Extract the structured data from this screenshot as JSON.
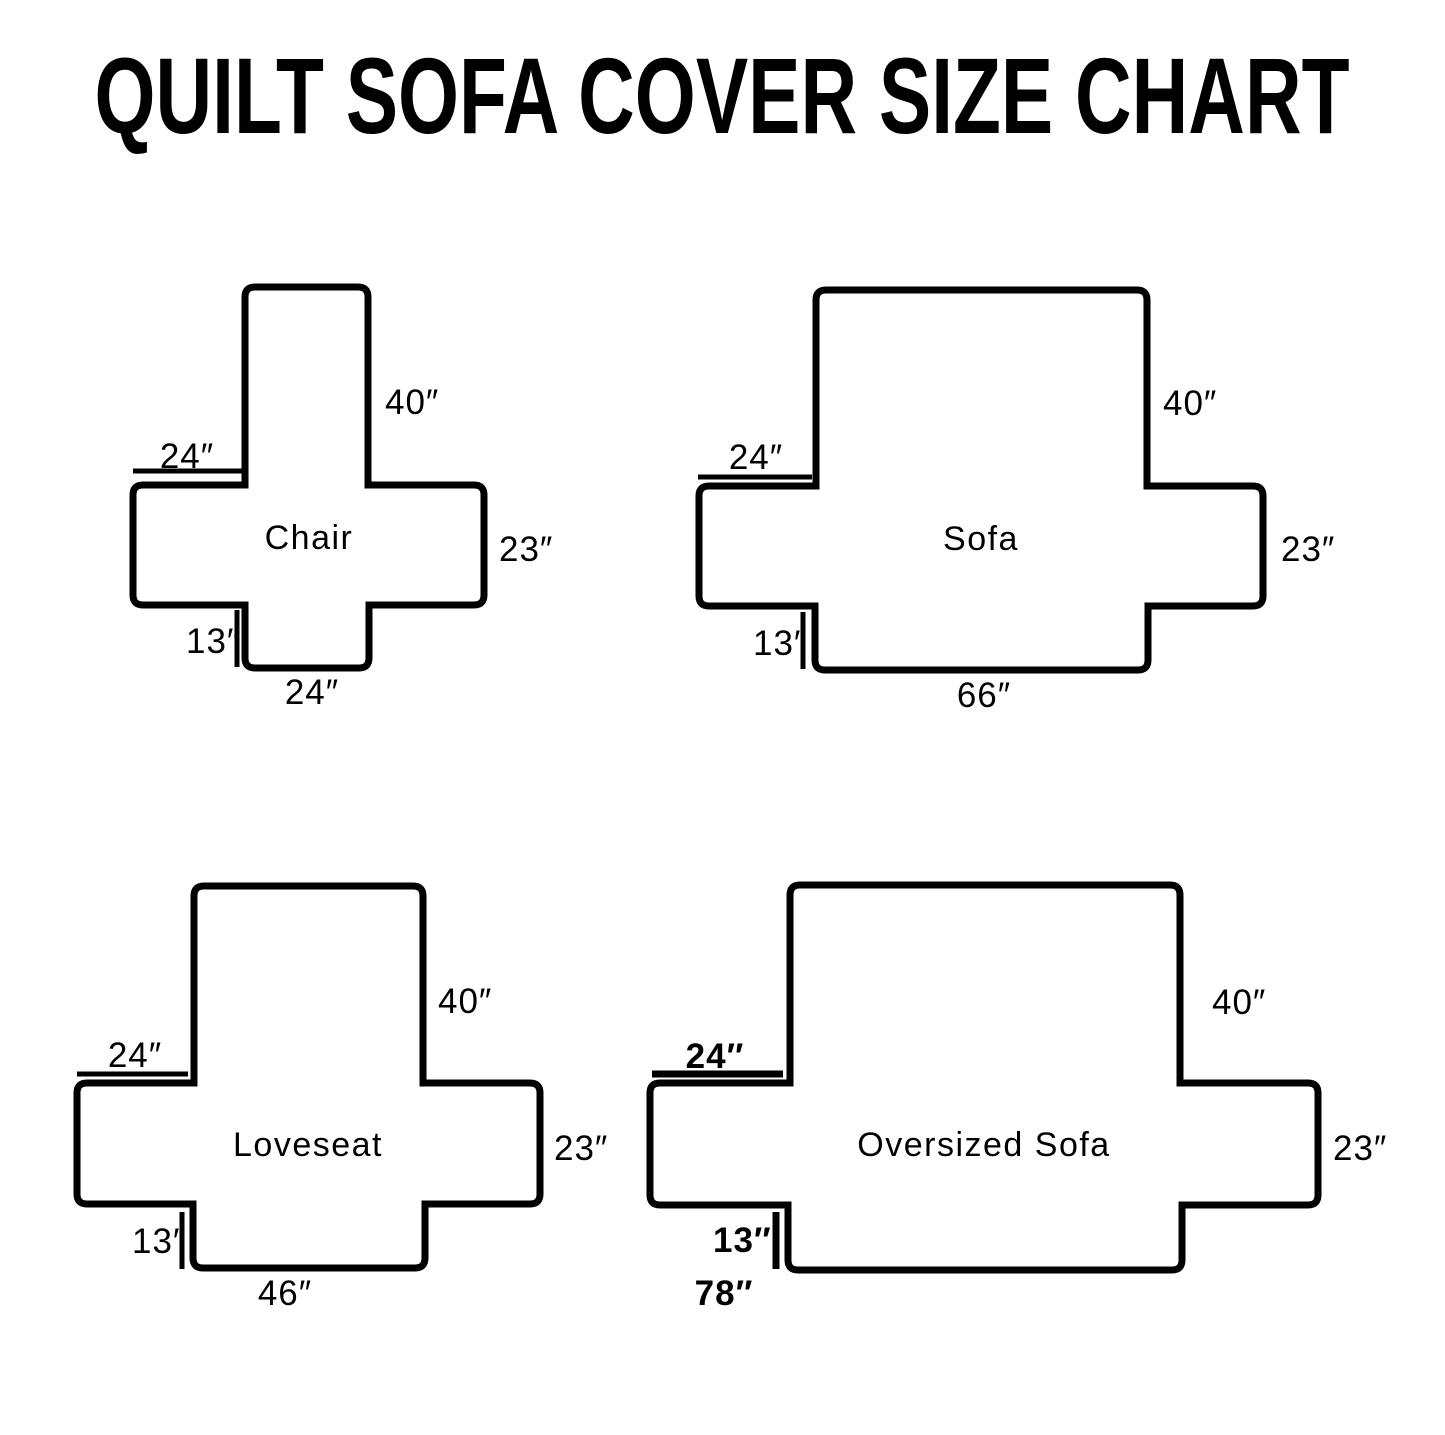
{
  "title": "QUILT SOFA COVER SIZE CHART",
  "ink_color": "#000000",
  "diagrams": [
    {
      "name": "Chair",
      "back_height": "40″",
      "arm_width": "24″",
      "seat_side": "23″",
      "front_drop": "13″",
      "bottom_width": "24″"
    },
    {
      "name": "Sofa",
      "back_height": "40″",
      "arm_width": "24″",
      "seat_side": "23″",
      "front_drop": "13″",
      "bottom_width": "66″"
    },
    {
      "name": "Loveseat",
      "back_height": "40″",
      "arm_width": "24″",
      "seat_side": "23″",
      "front_drop": "13″",
      "bottom_width": "46″"
    },
    {
      "name": "Oversized Sofa",
      "back_height": "40″",
      "arm_width": "24″",
      "seat_side": "23″",
      "front_drop": "13″",
      "bottom_width": "78″"
    }
  ]
}
